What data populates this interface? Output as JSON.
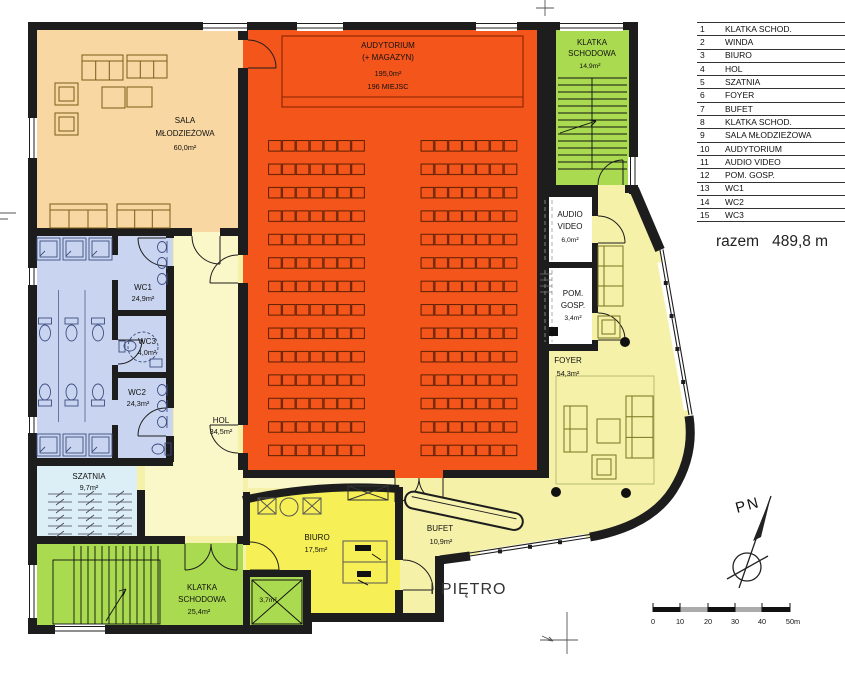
{
  "palette": {
    "wall": "#1d1d1d",
    "auditorium_orange": "#F3551B",
    "sala_peach": "#F8D7A2",
    "stairs_green": "#A9DA4F",
    "wc_blue": "#C9D5F0",
    "szatnia_blue": "#DCEFF6",
    "foyer_yellow": "#F6F1A8",
    "hol_yellow": "#FAF7C9",
    "biuro_yellow": "#F6EF55",
    "white_room": "#FFFFFF"
  },
  "legend": {
    "rows": [
      {
        "num": "1",
        "label": "KLATKA SCHOD."
      },
      {
        "num": "2",
        "label": "WINDA"
      },
      {
        "num": "3",
        "label": "BIURO"
      },
      {
        "num": "4",
        "label": "HOL"
      },
      {
        "num": "5",
        "label": "SZATNIA"
      },
      {
        "num": "6",
        "label": "FOYER"
      },
      {
        "num": "7",
        "label": "BUFET"
      },
      {
        "num": "8",
        "label": "KLATKA SCHOD."
      },
      {
        "num": "9",
        "label": "SALA MŁODZIEŻOWA"
      },
      {
        "num": "10",
        "label": "AUDYTORIUM"
      },
      {
        "num": "11",
        "label": "AUDIO VIDEO"
      },
      {
        "num": "12",
        "label": "POM. GOSP."
      },
      {
        "num": "13",
        "label": "WC1"
      },
      {
        "num": "14",
        "label": "WC2"
      },
      {
        "num": "15",
        "label": "WC3"
      }
    ]
  },
  "total": {
    "label": "razem",
    "value": "489,8 m"
  },
  "floor_title": "I PIĘTRO",
  "north_label": "PN",
  "scalebar": {
    "labels": [
      "0",
      "10",
      "20",
      "30",
      "40",
      "50m"
    ]
  },
  "rooms": {
    "sala": {
      "name1": "SALA",
      "name2": "MŁODZIEŻOWA",
      "area": "60,0m²"
    },
    "audytorium": {
      "name1": "AUDYTORIUM",
      "name2": "(+ MAGAZYN)",
      "area": "195,0m²",
      "seats": "196 MIEJSC"
    },
    "klatka_gorna": {
      "name1": "KLATKA",
      "name2": "SCHODOWA",
      "area": "14,9m²"
    },
    "audio_video": {
      "name1": "AUDIO",
      "name2": "VIDEO",
      "area": "6,0m²"
    },
    "pom_gosp": {
      "name1": "POM.",
      "name2": "GOSP.",
      "area": "3,4m²"
    },
    "foyer": {
      "name1": "FOYER",
      "area": "54,3m²"
    },
    "wc1": {
      "name1": "WC1",
      "area": "24,9m²"
    },
    "wc3": {
      "name1": "WC3",
      "area": "4,0m²"
    },
    "wc2": {
      "name1": "WC2",
      "area": "24,3m²"
    },
    "hol": {
      "name1": "HOL",
      "area": "34,5m²"
    },
    "szatnia": {
      "name1": "SZATNIA",
      "area": "9,7m²"
    },
    "klatka_dolna": {
      "name1": "KLATKA",
      "name2": "SCHODOWA",
      "area": "25,4m²"
    },
    "winda": {
      "area": "3,7m²"
    },
    "biuro": {
      "name1": "BIURO",
      "area": "17,5m²"
    },
    "bufet": {
      "name1": "BUFET",
      "area": "10,9m²"
    }
  }
}
